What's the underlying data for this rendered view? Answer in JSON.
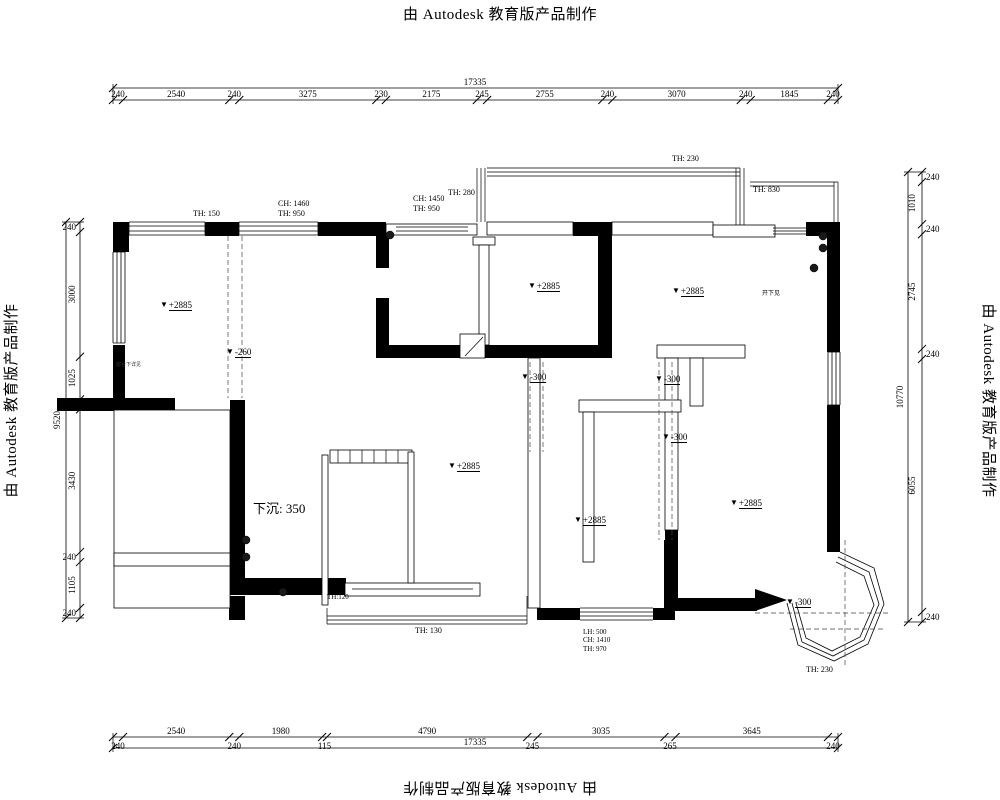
{
  "watermark": {
    "text": "由 Autodesk 教育版产品制作"
  },
  "icons": {
    "level_marker": "▼"
  },
  "dimensions": {
    "top": {
      "total": "17335",
      "segments": [
        "240",
        "2540",
        "240",
        "3275",
        "230",
        "2175",
        "245",
        "2755",
        "240",
        "3070",
        "240",
        "1845",
        "240"
      ]
    },
    "bottom": {
      "total": "17335",
      "segments": [
        "240",
        "2540",
        "240",
        "1980",
        "115",
        "4790",
        "245",
        "3035",
        "265",
        "3645",
        "240"
      ]
    },
    "left": {
      "total": "9520",
      "segments": [
        "240",
        "3000",
        "1025",
        "240",
        "3430",
        "240",
        "1105",
        "240"
      ]
    },
    "right": {
      "total": "10770",
      "segments": [
        "240",
        "1010",
        "240",
        "2745",
        "240",
        "6055",
        "240"
      ]
    }
  },
  "annotations": {
    "th_150": "TH: 150",
    "win_left": "CH: 1460\nTH: 950",
    "win_kitchen": "CH: 1450\nTH: 950",
    "th_280": "TH: 280",
    "th_230_top": "TH: 230",
    "th_830": "TH: 830",
    "lvl_a": "+2885",
    "lvl_b": "+2885",
    "lvl_c": "+2885",
    "lvl_d": "+2885",
    "lvl_e": "+2885",
    "lvl_f": "+2885",
    "lvl_260": "-260",
    "lvl_300_a": "-300",
    "lvl_300_b": "-300",
    "lvl_300_c": "-300",
    "lvl_300_bay": "-300",
    "sunken": "下沉: 350",
    "th_120": "TH:120",
    "th_130": "TH: 130",
    "win_bottom": "LH: 500\nCH: 1410\nTH: 970",
    "th_230_bay": "TH: 230",
    "note_left": "窗台下详见",
    "note_right": "开下见"
  }
}
